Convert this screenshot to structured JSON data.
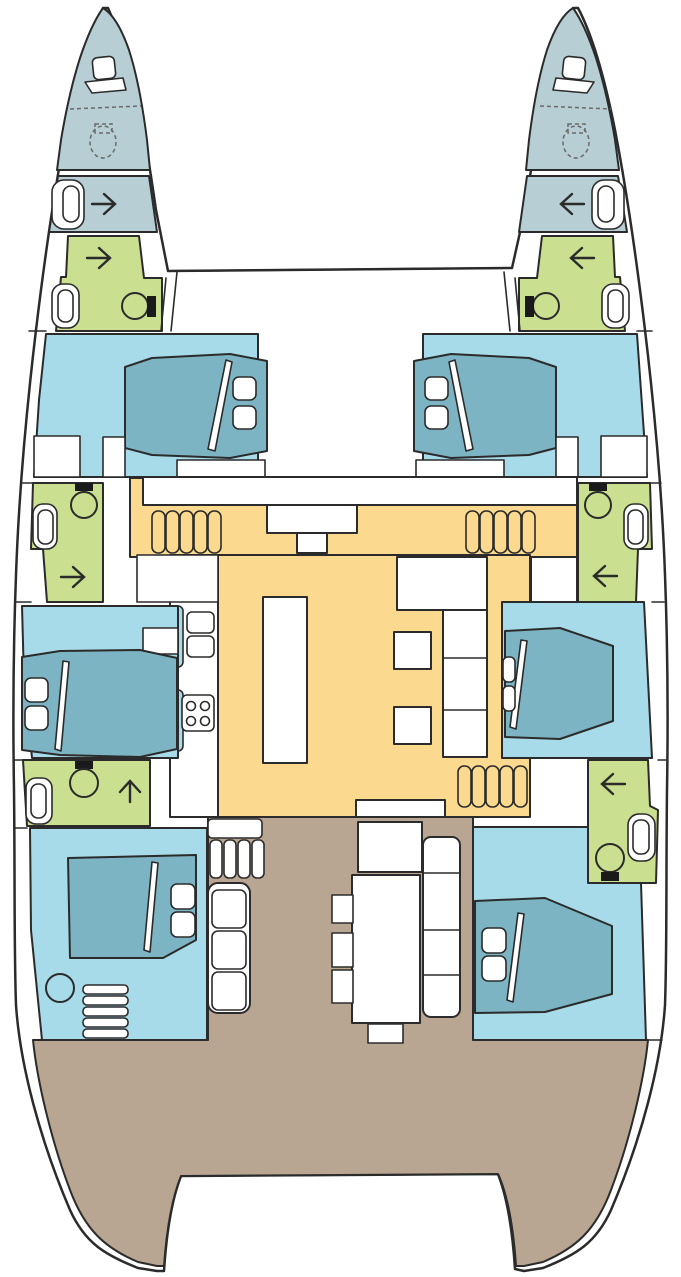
{
  "page": {
    "title": "Catamaran yacht deck / accommodation plan",
    "width_px": 681,
    "height_px": 1277
  },
  "colors": {
    "outline": "#2b2b2b",
    "dashed": "#6a6a6a",
    "hull_white": "#ffffff",
    "forepeak": "#b7ced4",
    "bathroom": "#cbdf90",
    "cabin": "#a7dbea",
    "bed": "#7db4c4",
    "salon": "#fbd98e",
    "cockpit": "#b8a692",
    "fixture_white": "#ffffff",
    "toilet_tank": "#1a1a1a"
  },
  "rooms": [
    {
      "id": "port-forepeak",
      "label": "Port forepeak locker / crew berth",
      "color": "forepeak"
    },
    {
      "id": "starboard-forepeak",
      "label": "Starboard forepeak locker / crew berth",
      "color": "forepeak"
    },
    {
      "id": "port-bow-compartment",
      "label": "Port bow compartment",
      "color": "forepeak"
    },
    {
      "id": "starboard-bow-compartment",
      "label": "Starboard bow compartment",
      "color": "forepeak"
    },
    {
      "id": "port-forward-head",
      "label": "Port forward bathroom",
      "color": "bathroom"
    },
    {
      "id": "starboard-forward-head",
      "label": "Starboard forward bathroom",
      "color": "bathroom"
    },
    {
      "id": "port-forward-cabin",
      "label": "Port forward double cabin",
      "color": "cabin"
    },
    {
      "id": "starboard-forward-cabin",
      "label": "Starboard forward double cabin",
      "color": "cabin"
    },
    {
      "id": "port-mid-head",
      "label": "Port midship bathroom",
      "color": "bathroom"
    },
    {
      "id": "starboard-mid-head",
      "label": "Starboard midship bathroom",
      "color": "bathroom"
    },
    {
      "id": "port-mid-cabin",
      "label": "Port midship double cabin",
      "color": "cabin"
    },
    {
      "id": "starboard-mid-cabin",
      "label": "Starboard midship double cabin",
      "color": "cabin"
    },
    {
      "id": "port-aft-head",
      "label": "Port aft bathroom",
      "color": "bathroom"
    },
    {
      "id": "starboard-aft-head",
      "label": "Starboard aft bathroom",
      "color": "bathroom"
    },
    {
      "id": "port-aft-cabin",
      "label": "Port aft double cabin",
      "color": "cabin"
    },
    {
      "id": "starboard-aft-cabin",
      "label": "Starboard aft double cabin",
      "color": "cabin"
    },
    {
      "id": "salon",
      "label": "Salon / galley on bridgedeck",
      "color": "salon"
    },
    {
      "id": "cockpit",
      "label": "Aft cockpit and stern platforms",
      "color": "cockpit"
    }
  ],
  "fixtures": {
    "double_berths": 6,
    "toilets": 6,
    "deck_hatches": 2,
    "companionway_stairs": 4,
    "icons": [
      "deck-hatch-icon",
      "sail-locker-icon",
      "dashed-seat-icon",
      "porthole-icon",
      "toilet-icon",
      "companionway-arrow-icon",
      "bed-icon",
      "pillow-icon",
      "stairs-icon",
      "stove-icon",
      "fridge-icon",
      "galley-island-icon",
      "settee-icon",
      "coffee-table-icon",
      "cockpit-table-icon",
      "cockpit-bench-icon",
      "chair-icon",
      "ladder-icon",
      "stool-icon"
    ]
  }
}
